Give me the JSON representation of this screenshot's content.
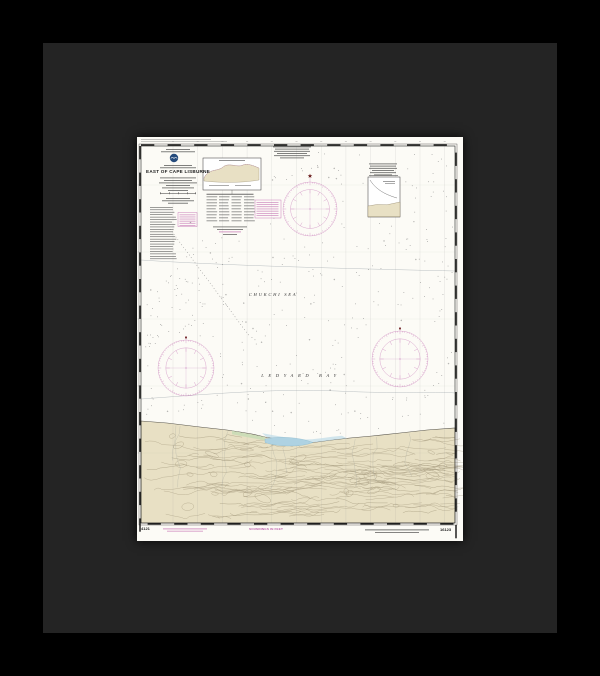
{
  "artwork": {
    "kind": "framed nautical chart print",
    "frame_color": "#000000",
    "mat_color": "#242424",
    "paper_color": "#fcfbf6"
  },
  "chart": {
    "title": "EAST OF CAPE LISBURNE",
    "sea_label": "CHUKCHI SEA",
    "bay_label": "LEDYARD BAY",
    "soundings_note": "SOUNDINGS IN FEET",
    "print_number": "4121",
    "chart_number": "16123",
    "colors": {
      "land": "#e8e0c4",
      "land_contour": "#8d8063",
      "land_contour_dark": "#7a6e50",
      "lagoon": "#aed2e2",
      "shore_band": "#bfdbe8",
      "marsh": "#c9dcb6",
      "magenta": "#bf64ad",
      "ink": "#3a3a3a",
      "grid": "#8a8a8a",
      "logo_blue": "#254b7c",
      "star_red": "#6b1f1f"
    }
  }
}
